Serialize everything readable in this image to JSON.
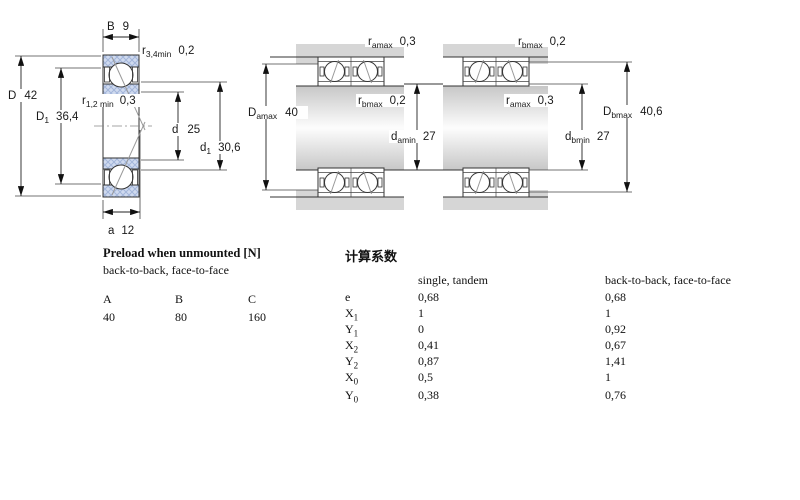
{
  "drawings": {
    "d1": {
      "B": {
        "sym": "B",
        "val": "9"
      },
      "r34": {
        "sym": "r",
        "sub": "3,4min",
        "val": "0,2"
      },
      "D": {
        "sym": "D",
        "val": "42"
      },
      "D1": {
        "sym": "D",
        "sub": "1",
        "val": "36,4"
      },
      "r12": {
        "sym": "r",
        "sub": "1,2 min",
        "val": "0,3"
      },
      "d": {
        "sym": "d",
        "val": "25"
      },
      "d1": {
        "sym": "d",
        "sub": "1",
        "val": "30,6"
      },
      "a": {
        "sym": "a",
        "val": "12"
      }
    },
    "d2": {
      "ramax": {
        "sym": "r",
        "sub": "amax",
        "val": "0,3"
      },
      "Damax": {
        "sym": "D",
        "sub": "amax",
        "val": "40"
      },
      "rbmax": {
        "sym": "r",
        "sub": "bmax",
        "val": "0,2"
      },
      "damin": {
        "sym": "d",
        "sub": "amin",
        "val": "27"
      }
    },
    "d3": {
      "rbmax": {
        "sym": "r",
        "sub": "bmax",
        "val": "0,2"
      },
      "ramax": {
        "sym": "r",
        "sub": "amax",
        "val": "0,3"
      },
      "Dbmax": {
        "sym": "D",
        "sub": "bmax",
        "val": "40,6"
      },
      "dbmin": {
        "sym": "d",
        "sub": "bmin",
        "val": "27"
      }
    }
  },
  "preload": {
    "title": "Preload when unmounted [N]",
    "subtitle": "back-to-back, face-to-face",
    "columns": [
      "A",
      "B",
      "C"
    ],
    "values": [
      "40",
      "80",
      "160"
    ]
  },
  "factors": {
    "title": "计算系数",
    "col1": "single, tandem",
    "col2": "back-to-back, face-to-face",
    "rows": [
      {
        "sym": "e",
        "sub": "",
        "v1": "0,68",
        "v2": "0,68"
      },
      {
        "sym": "X",
        "sub": "1",
        "v1": "1",
        "v2": "1"
      },
      {
        "sym": "Y",
        "sub": "1",
        "v1": "0",
        "v2": "0,92"
      },
      {
        "sym": "X",
        "sub": "2",
        "v1": "0,41",
        "v2": "0,67"
      },
      {
        "sym": "Y",
        "sub": "2",
        "v1": "0,87",
        "v2": "1,41"
      },
      {
        "sym": "X",
        "sub": "0",
        "v1": "0,5",
        "v2": "1"
      },
      {
        "sym": "Y",
        "sub": "0",
        "v1": "0,38",
        "v2": "0,76"
      }
    ]
  }
}
